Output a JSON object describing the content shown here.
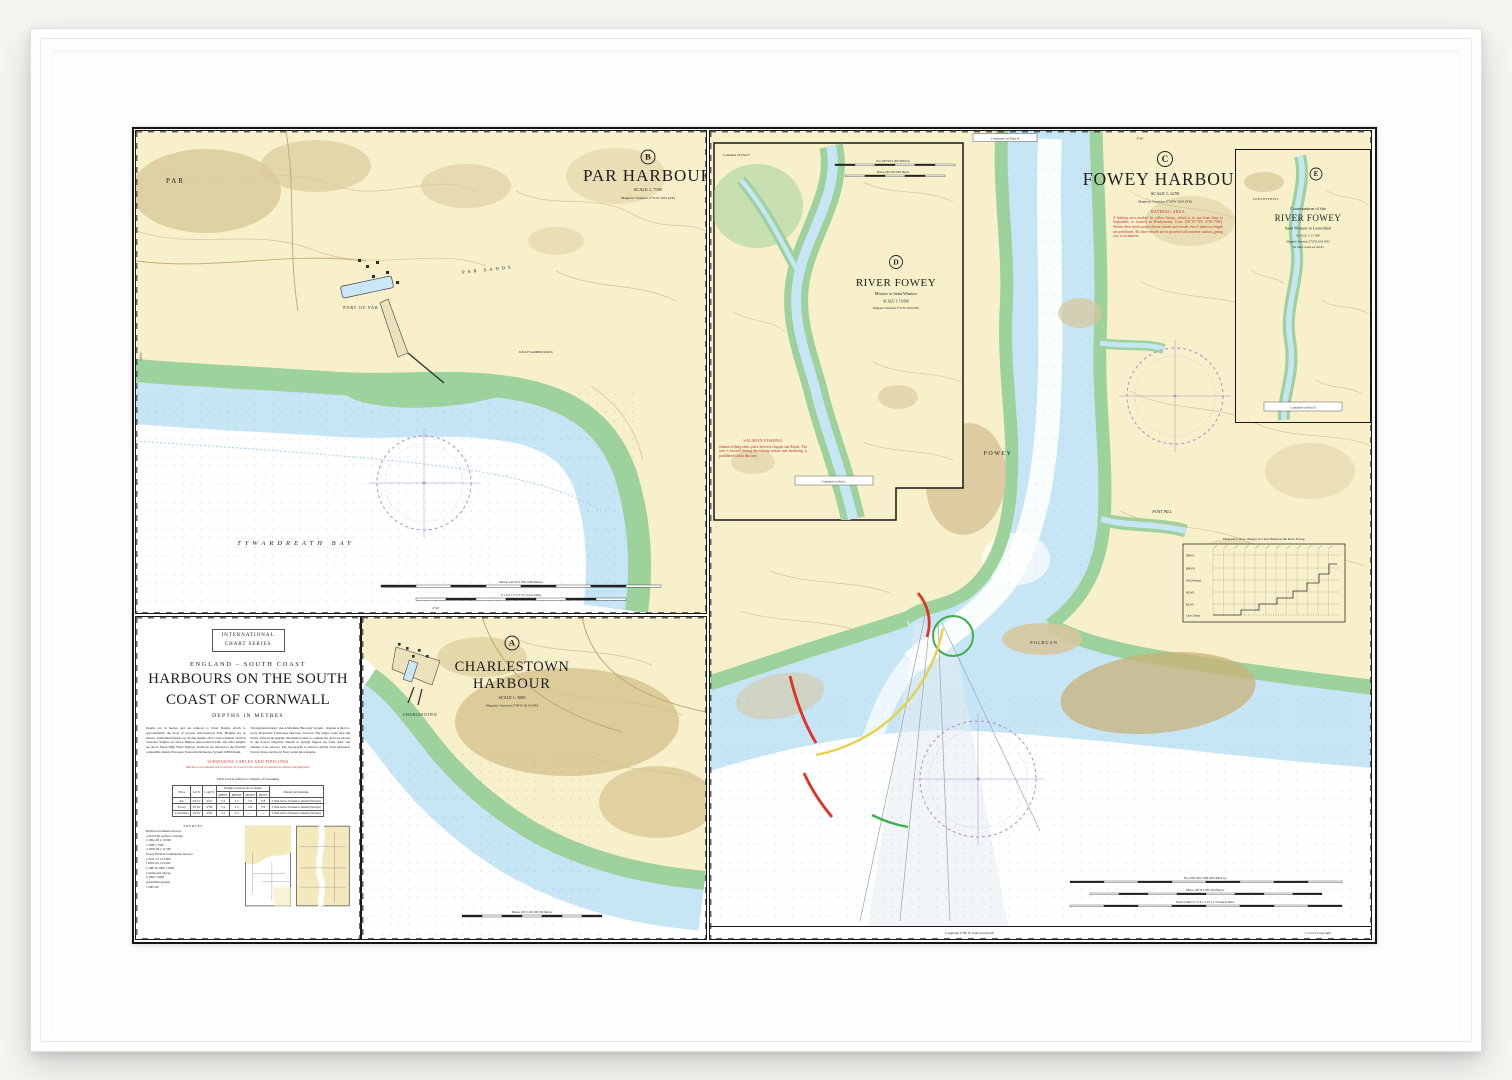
{
  "palette": {
    "land": "#f8f0ca",
    "intertidal_green": "#9ed29c",
    "shallow_blue": "#c6e6f5",
    "khaki": "#cdb87f",
    "compass_magenta": "#b08cc9",
    "danger_red": "#e23126",
    "sector_yellow": "#e8d14a",
    "sector_green": "#3fae4c",
    "warning_red": "#c0322a"
  },
  "chart": {
    "margin": {
      "bottom_left": "Longitude 4°38' W from Greenwich",
      "bottom_right": "© Crown Copyright",
      "b_long": "4°42'",
      "b_lat": "50°21'",
      "c_long": "4°36'"
    },
    "title_block": {
      "series1": "INTERNATIONAL",
      "series2": "CHART SERIES",
      "region": "ENGLAND – SOUTH COAST",
      "title1": "HARBOURS ON THE SOUTH",
      "title2": "COAST OF CORNWALL",
      "depths": "DEPTHS IN METRES",
      "notes_left": "Depths are in metres and are reduced to Chart Datum, which is approximately the level of Lowest Astronomical Tide. Heights are in metres. Underlined figures are drying heights above Chart Datum. Vertical clearance heights are above Highest Astronomical Tide. All other heights are above Mean High Water Springs. Positions are referred to the WGS84 compatible datum, European Terrestrial Reference System 1989 Datum.",
      "notes_right": "Navigational marks: IALA Maritime Buoyage System – Region A (Red to port). Projection: Transverse Mercator. Sources: The origin, scale, date and limits of the hydrographic information used to compile the chart are shown in the Source Diagram. Depths in upright figures are from older and smaller scale surveys. The topography is derived chiefly from Ordnance Survey maps and Royal Navy aerial photographs.",
      "cables_heading": "SUBMARINE CABLES AND PIPELINES",
      "cables_text": "Mariners are advised not to anchor or trawl in the vicinity of submarine cables and pipelines.",
      "tidal_table": {
        "caption": "Tidal Levels referred to Datum of Soundings",
        "col_place": "Place",
        "col_lat": "Lat N",
        "col_long": "Long W",
        "col_heights": "Heights in metres above datum",
        "col_mhws": "MHWS",
        "col_mhwn": "MHWN",
        "col_mlwn": "MLWN",
        "col_mlws": "MLWS",
        "col_remarks": "Datum and Remarks",
        "rows": [
          {
            "place": "Par",
            "lat": "50°21'",
            "lon": "4°42'",
            "mhws": "5·4",
            "mhwn": "4·2",
            "mlwn": "2·0",
            "mlws": "0·8",
            "remarks": "2·91m below Ordnance Datum (Newlyn)"
          },
          {
            "place": "Fowey",
            "lat": "50°20'",
            "lon": "4°38'",
            "mhws": "5·4",
            "mhwn": "4·3",
            "mlwn": "2·0",
            "mlws": "0·6",
            "remarks": "3·20m below Ordnance Datum (Newlyn)"
          },
          {
            "place": "Lostwithiel",
            "lat": "50°24'",
            "lon": "4°40'",
            "mhws": "5·4",
            "mhwn": "4·3",
            "mlwn": "—",
            "mlws": "—",
            "remarks": "3·20m below Ordnance Datum (Newlyn)"
          }
        ]
      },
      "sources": {
        "heading": "SOURCES",
        "lines": [
          "British Government Surveys",
          "a   2010   Full seafloor coverage",
          "b   1992–96   1:10 000",
          "c   1986   1:7500",
          "d   1958–60   1:12 500",
          "Fowey Harbour Commission Surveys",
          "e   2012–13   1:10 000",
          "f   2003–09   1:10 000",
          "g   1987 & 1996   1:5000",
          "Commercial Survey",
          "h   1990   1:5000",
          "Aerial Photography",
          "i   1985–89"
        ]
      }
    },
    "panels": {
      "par": {
        "letter": "B",
        "title": "PAR HARBOUR",
        "scale": "SCALE 1: 7500",
        "magnetic": "Magnetic Variation 2°51'W 2014 (9'E)",
        "labels": {
          "town": "PAR",
          "port": "PORT OF PAR",
          "sands": "PAR SANDS",
          "rock": "KILLYVARDER ROCK",
          "bay": "TYWARDREATH  BAY"
        },
        "scalebar1": "Metres 100  50  0  500  1000 Metres",
        "scalebar2": "0·1   0   0·1   0·2   0·3   0·4  Sea Miles"
      },
      "charlestown": {
        "letter": "A",
        "title1": "CHARLESTOWN",
        "title2": "HARBOUR",
        "scale": "SCALE 1: 5000",
        "magnetic": "Magnetic Variation 2°49'W 2014 (9'E)",
        "labels": {
          "town": "CHARLESTOWN"
        },
        "scalebar": "Metres 100  0  100  200  300 Metres"
      },
      "fowey": {
        "letter": "C",
        "title": "FOWEY HARBOUR",
        "scale": "SCALE 1: 6250",
        "magnetic": "Magnetic Variation 2°50'W 2014 (9'E)",
        "continued_top": "Continued on Plan D",
        "bathing_heading": "BATHING AREA",
        "bathing_text": "A bathing area marked by yellow buoys, which is in use from June to September, is located in Readymoney Cove (50°19'·75N 4°38'·70W). Within these limits power-driven vessels and vessels over 6 metres in length are prohibited. All other vessels are to proceed with extreme caution, giving way to swimmers.",
        "labels": {
          "fowey": "FOWEY",
          "polruan": "POLRUAN",
          "pont_pill": "PONT PILL"
        },
        "diagram_title": "Diagram to show changes in Chart Datum in the River Fowey",
        "diagram_rows": [
          "MHWS",
          "MHWN",
          "OD (Newlyn)",
          "MLWN",
          "MLWS",
          "Chart Datum"
        ],
        "scalebar_feet": "Feet 1000  500  0  1000  2000  3000 Feet",
        "scalebar_metres": "Metres 100  50  0  500  1000 Metres",
        "scalebar_nm": "Nautical Miles 0·1  0  0·1  0·2  0·3  0·4 Nautical Miles"
      },
      "river_fowey": {
        "letter": "D",
        "title": "RIVER FOWEY",
        "subtitle": "Mixtow to Saint Winnow",
        "scale": "SCALE 1: 15 000",
        "magnetic": "Magnetic Variation 2°51'W 2014 (9'E)",
        "continued_top": "Continued on Plan E",
        "continued_bottom": "Continued on Plan C",
        "salmon_heading": "SALMON FISHING",
        "salmon_text": "Salmon fishing takes place between August and Easter. The area is buoyed during the fishing season and anchoring is prohibited within this area.",
        "scalebar_feet": "Feet 1000  500  0  1000  2000 Feet",
        "scalebar_metres": "Metres 100  0  500  1000 Metres"
      },
      "continuation": {
        "letter": "E",
        "pre": "Continuation of the",
        "title": "RIVER FOWEY",
        "subtitle": "Saint Winnow to Lostwithiel",
        "scale": "SCALE 1: 15 000",
        "magnetic": "Magnetic Variation 2°53'W 2014 (9'E)",
        "linear": "For linear scales see plan D",
        "labels": {
          "town": "LOSTWITHIEL"
        },
        "continued_bottom": "Continued on Plan D"
      }
    }
  }
}
